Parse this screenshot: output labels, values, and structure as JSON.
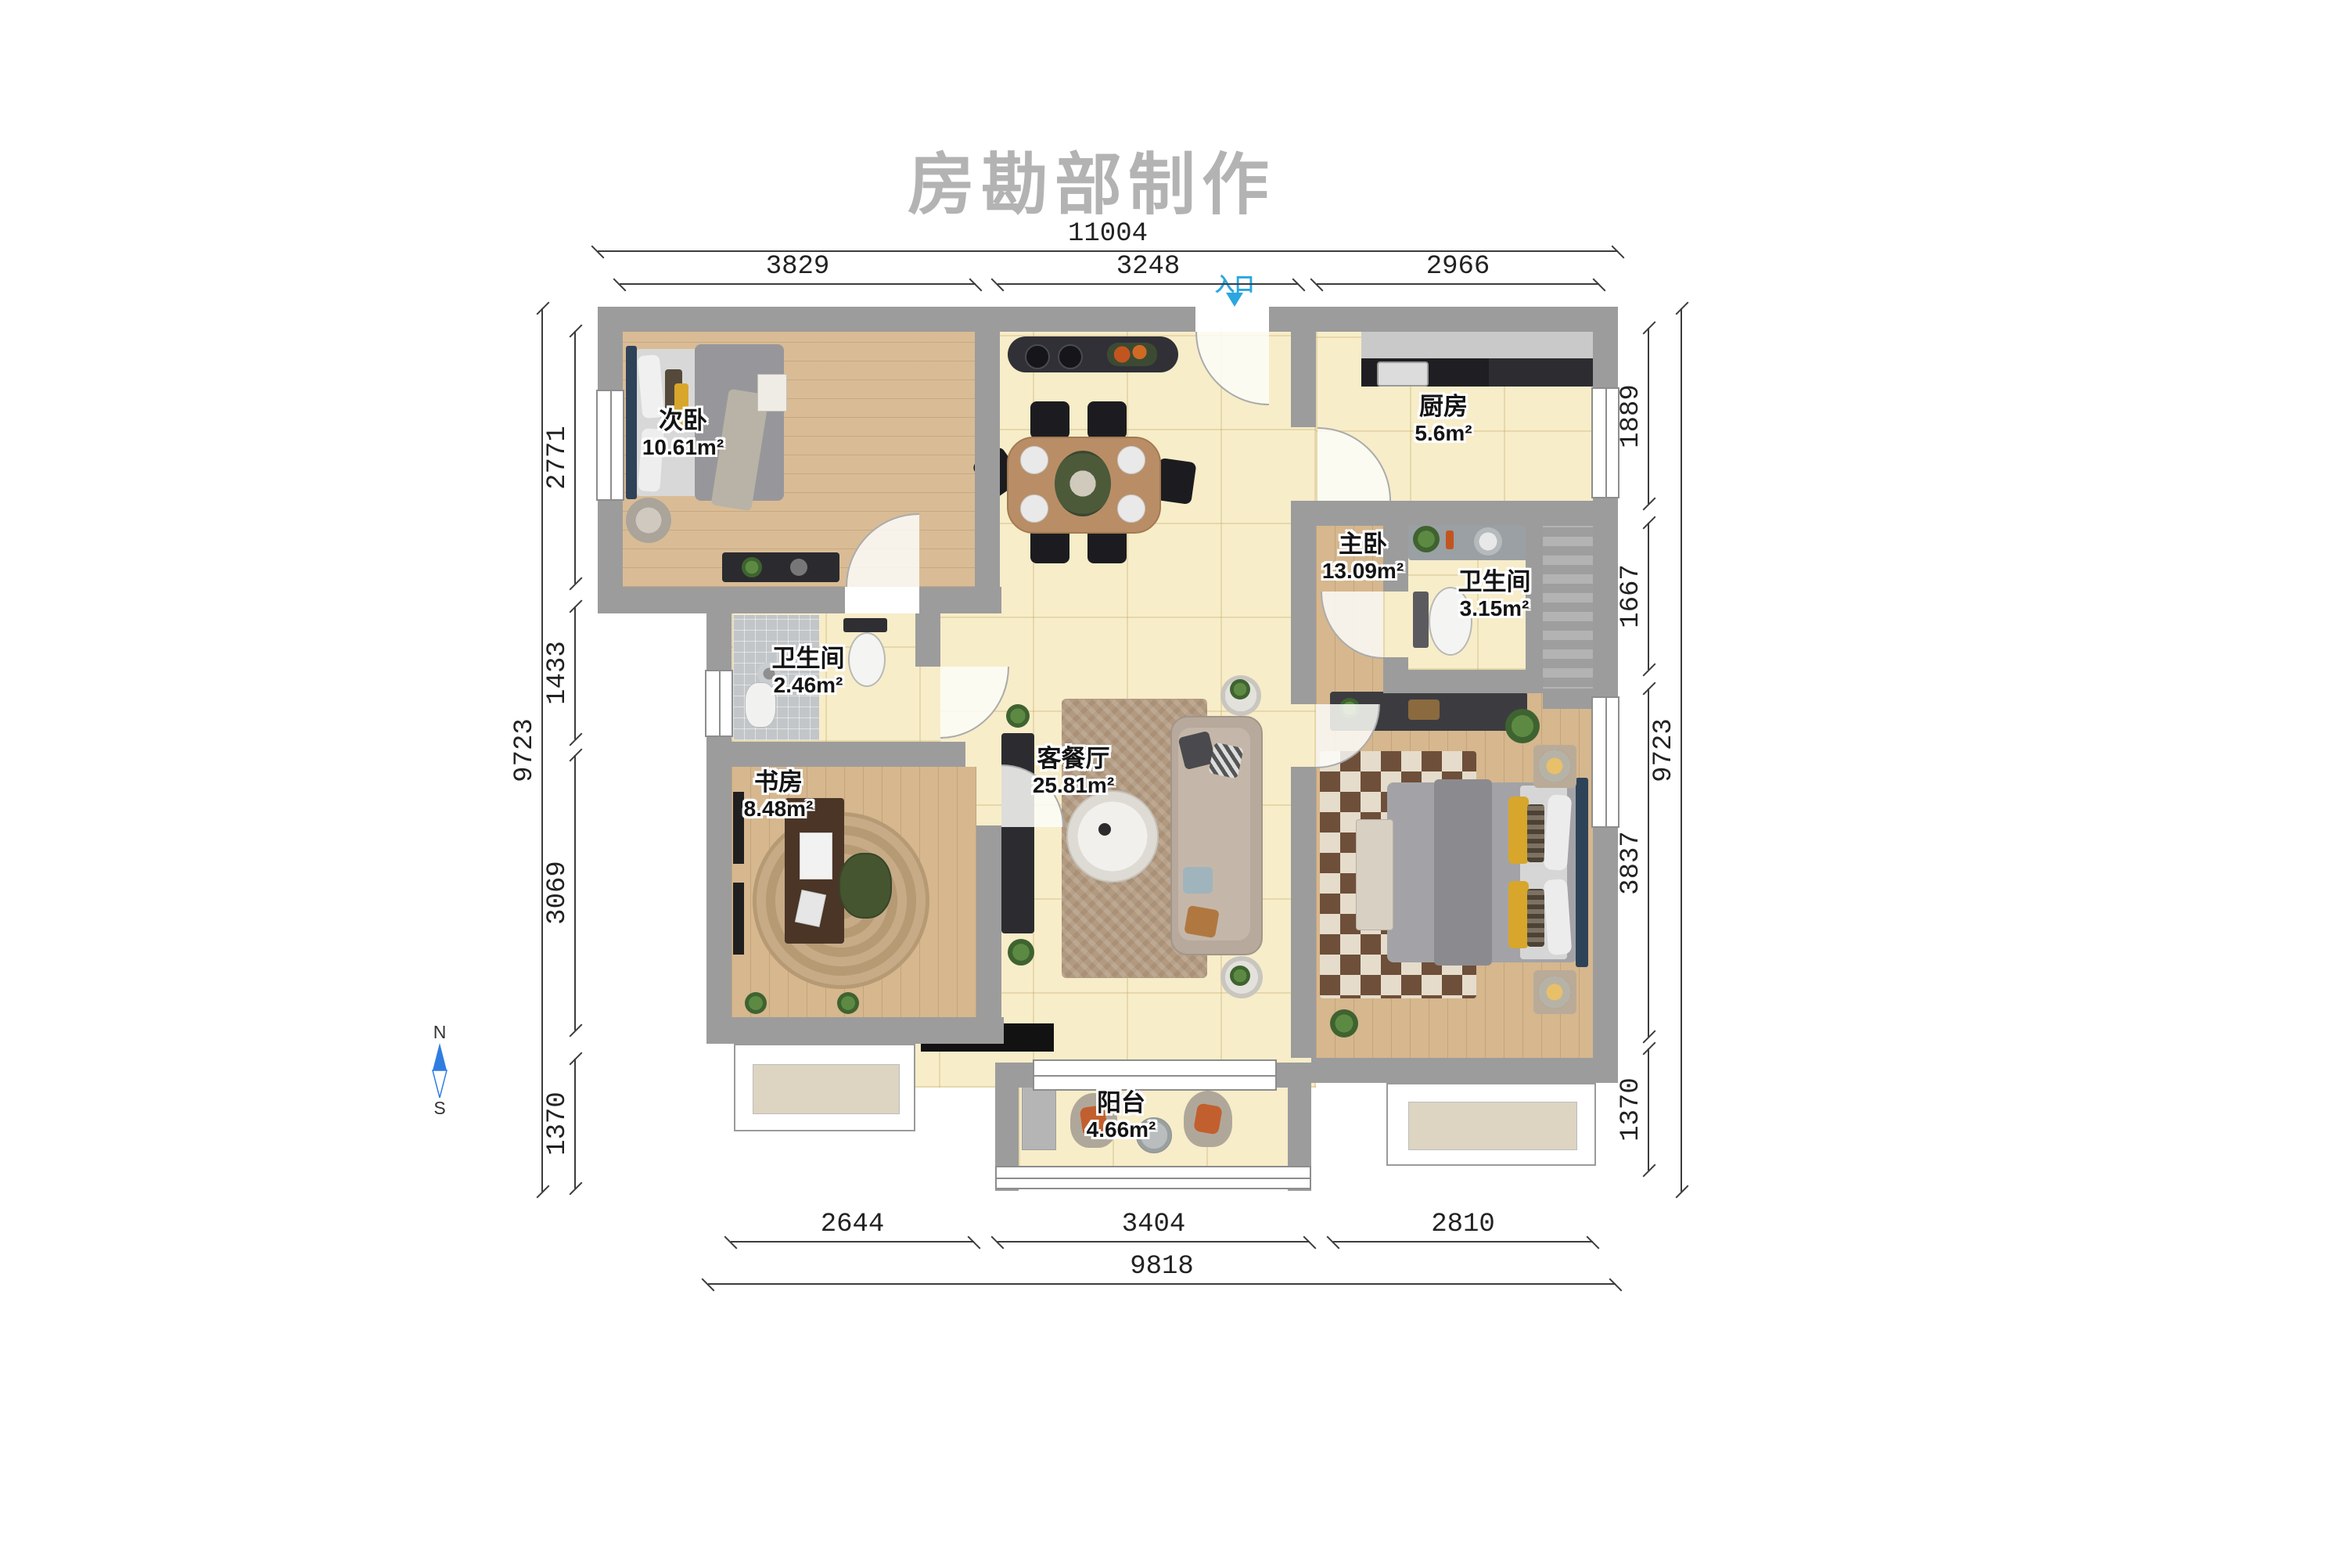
{
  "title": "房勘部制作",
  "entrance": {
    "label": "入口"
  },
  "compass": {
    "north": "N",
    "south": "S"
  },
  "rooms": [
    {
      "name": "次卧",
      "area": "10.61m²"
    },
    {
      "name": "厨房",
      "area": "5.6m²"
    },
    {
      "name": "主卧",
      "area": "13.09m²"
    },
    {
      "name": "卫生间",
      "area": "3.15m²"
    },
    {
      "name": "卫生间",
      "area": "2.46m²"
    },
    {
      "name": "书房",
      "area": "8.48m²"
    },
    {
      "name": "客餐厅",
      "area": "25.81m²"
    },
    {
      "name": "阳台",
      "area": "4.66m²"
    }
  ],
  "dimensions": {
    "top_total": "11004",
    "top_segments": [
      "3829",
      "3248",
      "2966"
    ],
    "left_total": "9723",
    "left_segments": [
      "2771",
      "1433",
      "3069",
      "1370"
    ],
    "right_total": "9723",
    "right_segments": [
      "1889",
      "1667",
      "3837",
      "1370"
    ],
    "bottom_total": "9818",
    "bottom_segments": [
      "2644",
      "3404",
      "2810"
    ]
  }
}
